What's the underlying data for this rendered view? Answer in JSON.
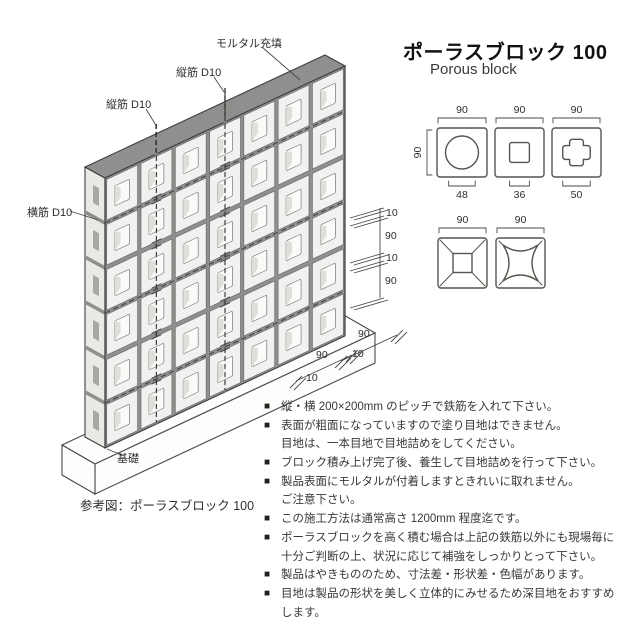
{
  "header": {
    "title": "ポーラスブロック 100",
    "subtitle": "Porous block"
  },
  "diagram": {
    "labels": {
      "mortar_fill": "モルタル充填",
      "vertical_rebar_1": "縦筋 D10",
      "vertical_rebar_2": "縦筋 D10",
      "horizontal_rebar": "横筋 D10",
      "foundation": "基礎",
      "caption": "参考図：ポーラスブロック 100"
    },
    "wall": {
      "rows": 6,
      "cols": 7
    },
    "right_dims": [
      "10",
      "90",
      "10",
      "90"
    ],
    "bottom_dims_upper": [
      "90",
      "10"
    ],
    "bottom_dims_lower": [
      "90",
      "10"
    ]
  },
  "block_types": {
    "row1": [
      {
        "name": "circle-hole-block",
        "top": "90",
        "left": "90",
        "bottom": "48"
      },
      {
        "name": "square-hole-block",
        "top": "90",
        "bottom": "36"
      },
      {
        "name": "cross-hole-block",
        "top": "90",
        "bottom": "50"
      }
    ],
    "row2": [
      {
        "name": "pyramid-face-block",
        "top": "90"
      },
      {
        "name": "cushion-face-block",
        "top": "90"
      }
    ]
  },
  "notes": {
    "marker": "■",
    "lines": [
      {
        "m": true,
        "t": "縦・横 200×200mm のピッチで鉄筋を入れて下さい。"
      },
      {
        "m": true,
        "t": "表面が粗面になっていますので塗り目地はできません。"
      },
      {
        "m": false,
        "t": "目地は、一本目地で目地詰めをしてください。"
      },
      {
        "m": true,
        "t": "ブロック積み上げ完了後、養生して目地詰めを行って下さい。"
      },
      {
        "m": true,
        "t": "製品表面にモルタルが付着しますときれいに取れません。"
      },
      {
        "m": false,
        "t": "ご注意下さい。"
      },
      {
        "m": true,
        "t": "この施工方法は通常高さ 1200mm 程度迄です。"
      },
      {
        "m": true,
        "t": "ポーラスブロックを高く積む場合は上記の鉄筋以外にも現場毎に"
      },
      {
        "m": false,
        "t": "十分ご判断の上、状況に応じて補強をしっかりとって下さい。"
      },
      {
        "m": true,
        "t": "製品はやきもののため、寸法差・形状差・色幅があります。"
      },
      {
        "m": true,
        "t": "目地は製品の形状を美しく立体的にみせるため深目地をおすすめ"
      },
      {
        "m": false,
        "t": "します。"
      }
    ]
  },
  "colors": {
    "mortar": "#8f8f8d",
    "mortar_dark": "#7f7f7d",
    "block_face": "#f1f1ef",
    "end_face": "#e9e9e6",
    "end_slot": "#a8a8a5",
    "hole_fill": "#fafaf8",
    "hole_shade": "#dededb",
    "outline": "#3e3e3c",
    "thin_line": "#6a6a68",
    "text": "#2e2e2e",
    "bullet": "#241f1d"
  }
}
